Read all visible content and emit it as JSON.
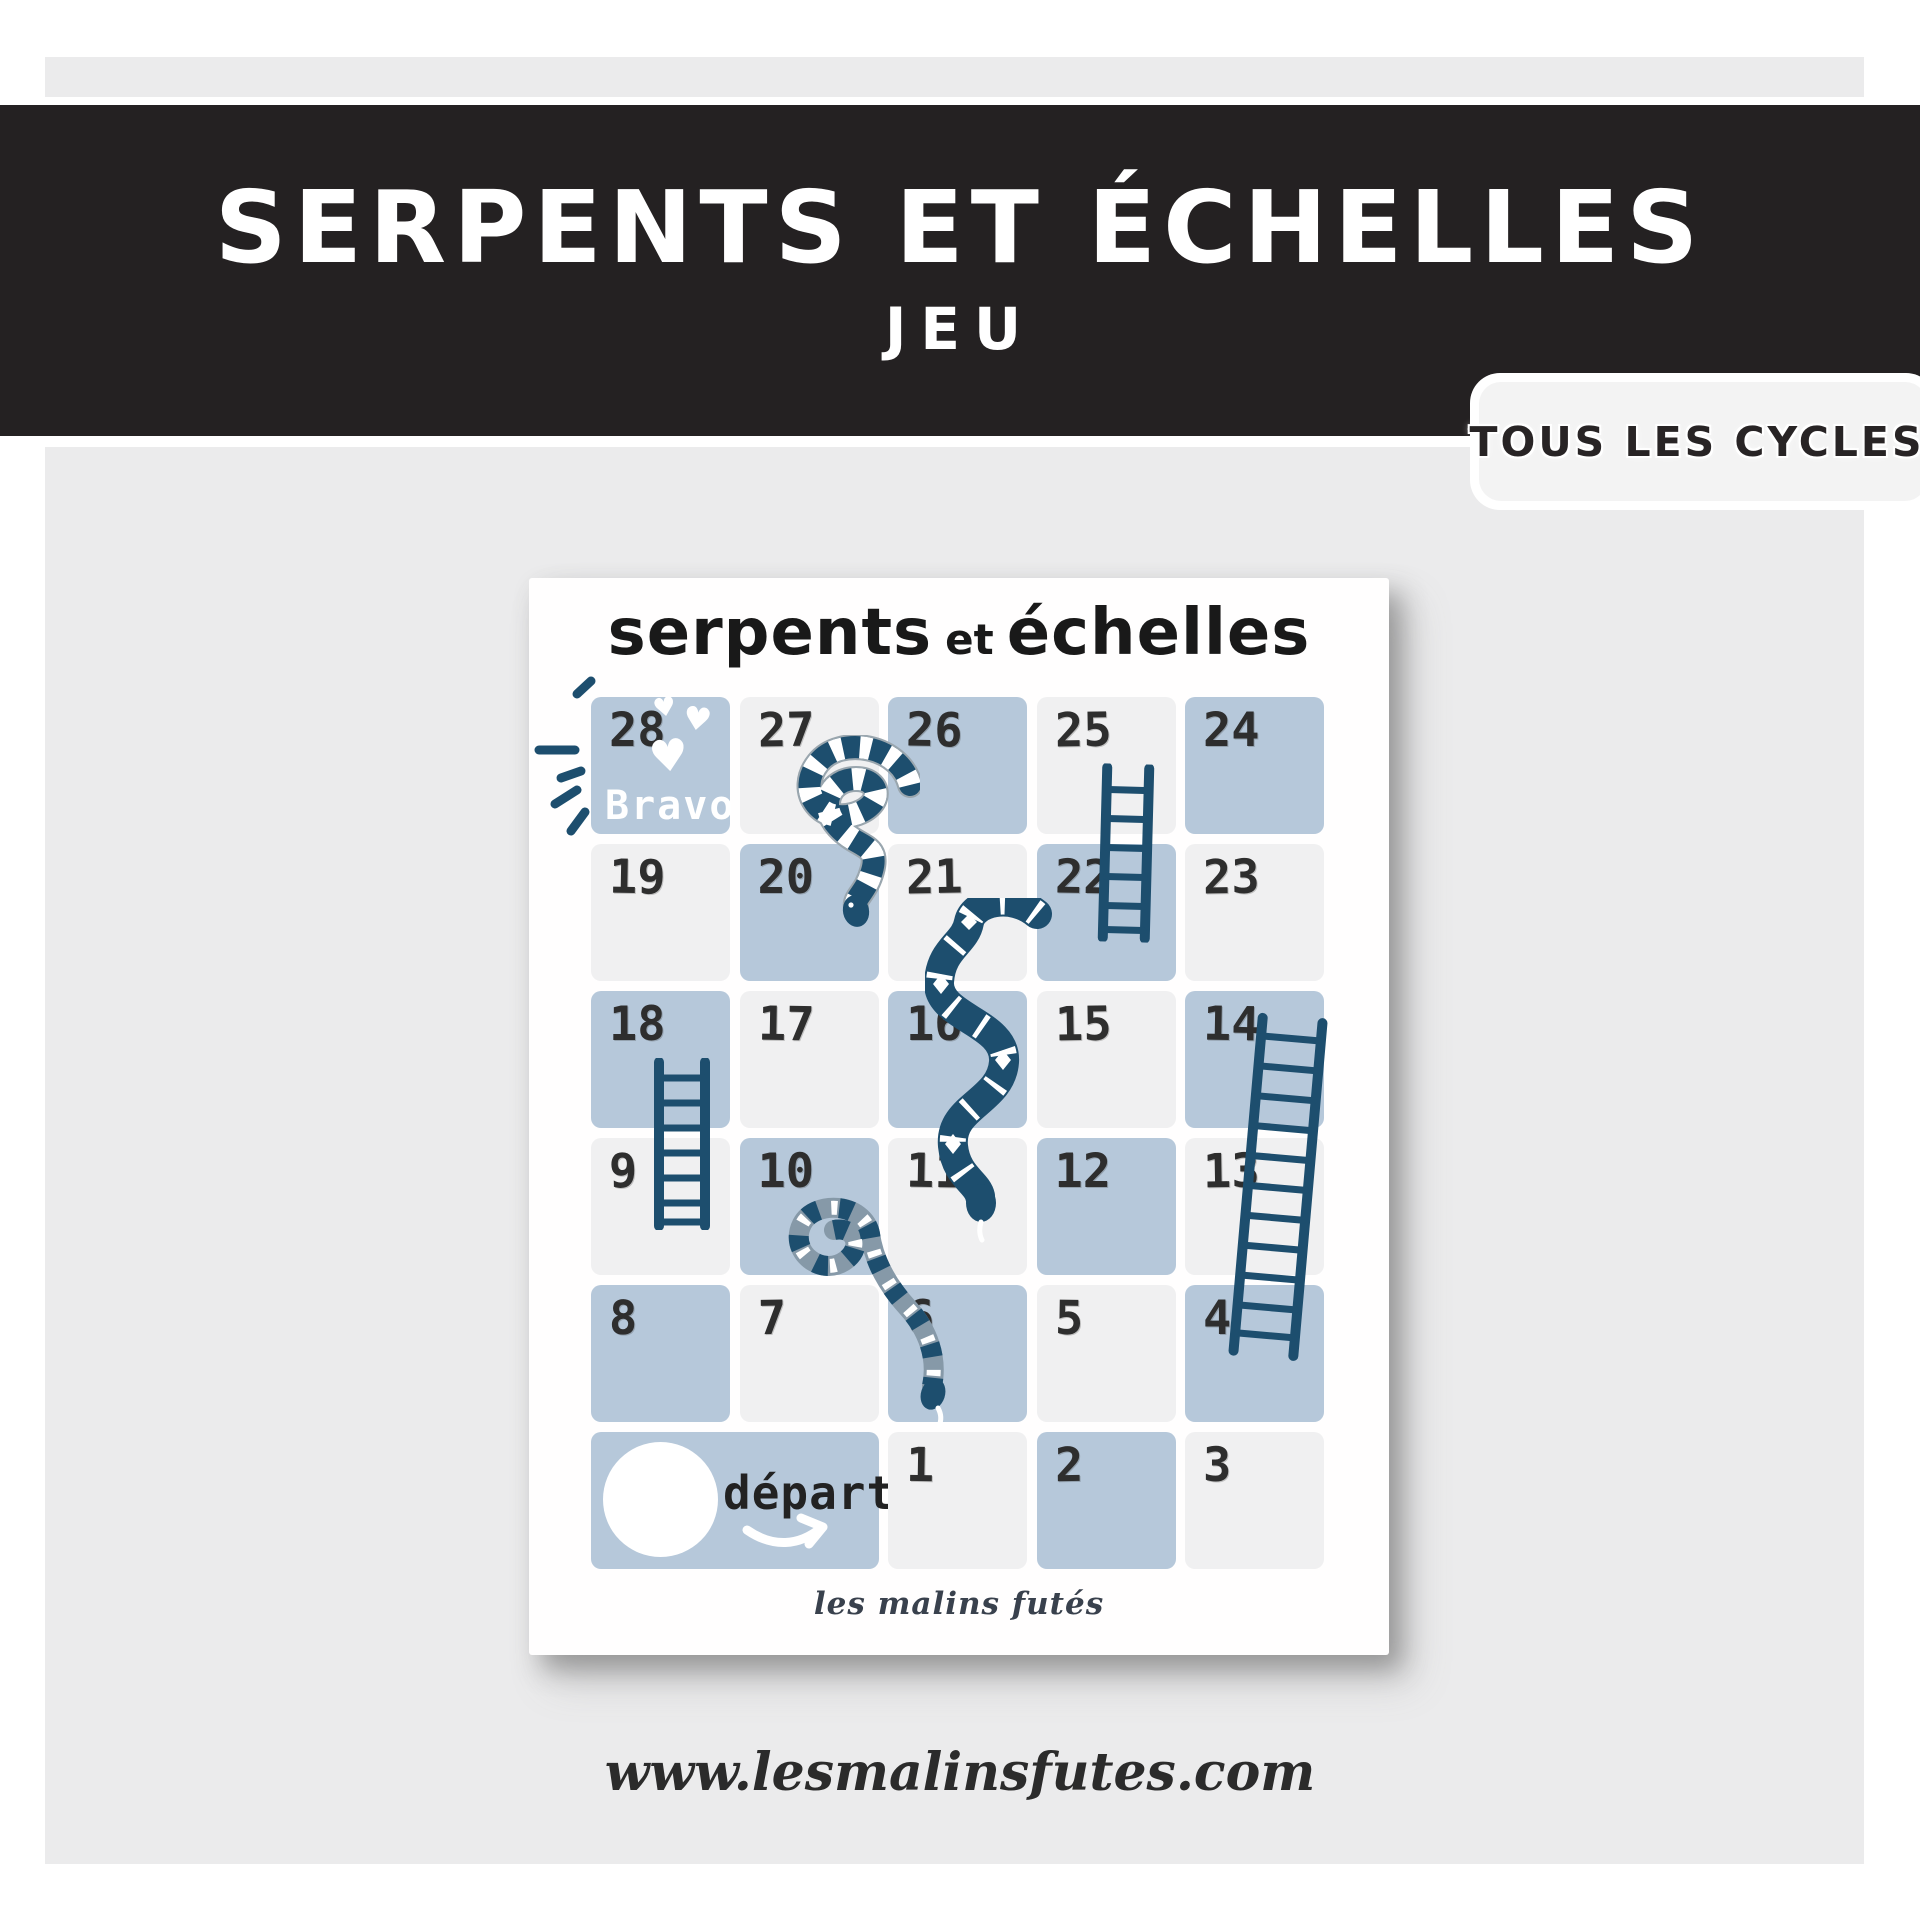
{
  "banner": {
    "title": "SERPENTS ET ÉCHELLES",
    "subtitle": "JEU"
  },
  "badge": {
    "label": "TOUS LES CYCLES"
  },
  "card": {
    "title": {
      "part1": "serpents",
      "part2": "et",
      "part3": "échelles"
    },
    "bravo_label": "Bravo!",
    "signature": "les malins futés",
    "board": {
      "rows": 6,
      "cols": 5,
      "cells": [
        {
          "label": "28",
          "row": 0,
          "col": 0,
          "color": "blue",
          "special": "bravo"
        },
        {
          "label": "27",
          "row": 0,
          "col": 1,
          "color": "gray"
        },
        {
          "label": "26",
          "row": 0,
          "col": 2,
          "color": "blue"
        },
        {
          "label": "25",
          "row": 0,
          "col": 3,
          "color": "gray"
        },
        {
          "label": "24",
          "row": 0,
          "col": 4,
          "color": "blue"
        },
        {
          "label": "19",
          "row": 1,
          "col": 0,
          "color": "gray"
        },
        {
          "label": "20",
          "row": 1,
          "col": 1,
          "color": "blue"
        },
        {
          "label": "21",
          "row": 1,
          "col": 2,
          "color": "gray"
        },
        {
          "label": "22",
          "row": 1,
          "col": 3,
          "color": "blue"
        },
        {
          "label": "23",
          "row": 1,
          "col": 4,
          "color": "gray"
        },
        {
          "label": "18",
          "row": 2,
          "col": 0,
          "color": "blue"
        },
        {
          "label": "17",
          "row": 2,
          "col": 1,
          "color": "gray"
        },
        {
          "label": "16",
          "row": 2,
          "col": 2,
          "color": "blue"
        },
        {
          "label": "15",
          "row": 2,
          "col": 3,
          "color": "gray"
        },
        {
          "label": "14",
          "row": 2,
          "col": 4,
          "color": "blue"
        },
        {
          "label": "9",
          "row": 3,
          "col": 0,
          "color": "gray"
        },
        {
          "label": "10",
          "row": 3,
          "col": 1,
          "color": "blue"
        },
        {
          "label": "11",
          "row": 3,
          "col": 2,
          "color": "gray"
        },
        {
          "label": "12",
          "row": 3,
          "col": 3,
          "color": "blue"
        },
        {
          "label": "13",
          "row": 3,
          "col": 4,
          "color": "gray"
        },
        {
          "label": "8",
          "row": 4,
          "col": 0,
          "color": "blue"
        },
        {
          "label": "7",
          "row": 4,
          "col": 1,
          "color": "gray"
        },
        {
          "label": "6",
          "row": 4,
          "col": 2,
          "color": "blue"
        },
        {
          "label": "5",
          "row": 4,
          "col": 3,
          "color": "gray"
        },
        {
          "label": "4",
          "row": 4,
          "col": 4,
          "color": "blue"
        },
        {
          "label": "départ",
          "row": 5,
          "col": 0,
          "colspan": 2,
          "color": "blue",
          "special": "depart"
        },
        {
          "label": "1",
          "row": 5,
          "col": 2,
          "color": "gray"
        },
        {
          "label": "2",
          "row": 5,
          "col": 3,
          "color": "blue"
        },
        {
          "label": "3",
          "row": 5,
          "col": 4,
          "color": "gray"
        }
      ]
    }
  },
  "footer": {
    "url": "www.lesmalinsfutes.com"
  },
  "colors": {
    "banner_bg": "#242122",
    "panel_bg": "#ebebec",
    "badge_bg": "#f3f3f3",
    "cell_blue": "#b6c8da",
    "cell_gray": "#f0f0f1",
    "navy": "#1d4e6e",
    "snake_gray": "#8699a8",
    "number": "#2e2e2e"
  }
}
